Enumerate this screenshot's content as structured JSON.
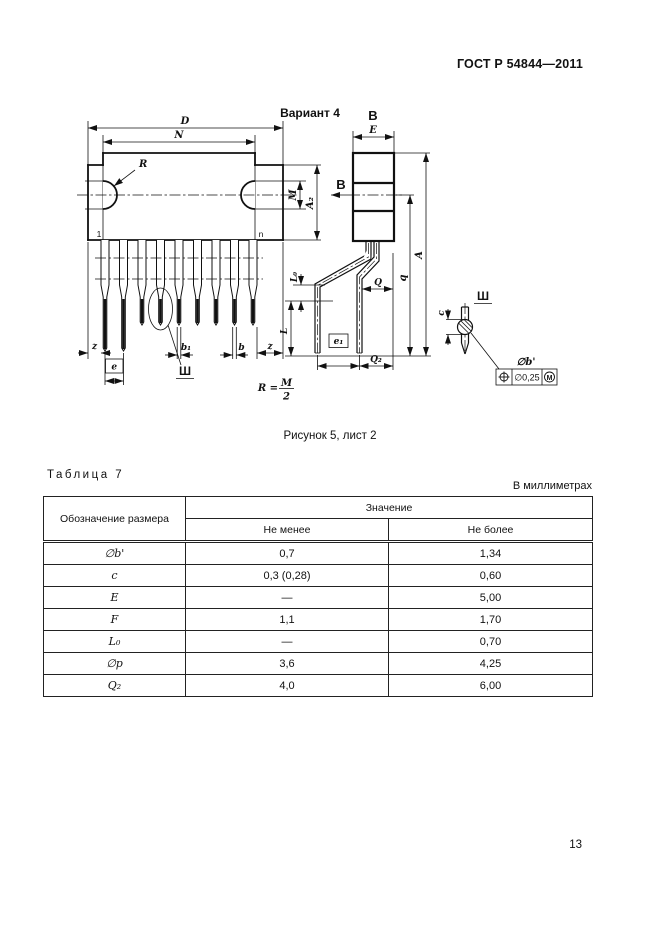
{
  "page": {
    "standard": "ГОСТ Р 54844—2011",
    "number": "13"
  },
  "figure": {
    "variant": "Вариант 4",
    "caption": "Рисунок 5, лист 2",
    "view_letter": "В",
    "detail_letter": "Ш",
    "formula_lhs": "R =",
    "formula_num": "M",
    "formula_den": "2",
    "dims": {
      "D": "D",
      "N": "N",
      "R": "R",
      "M": "M",
      "A2": "A₂",
      "pin_first": "1",
      "pin_last": "n",
      "z_left": "z",
      "z_right": "z",
      "e": "e",
      "b1": "b₁",
      "b": "b",
      "E": "E",
      "A": "A",
      "q": "q",
      "Q": "Q",
      "L0": "L₀",
      "L": "L",
      "e1": "e₁",
      "Q2": "Q₂",
      "c": "c",
      "db": "∅b'",
      "tol_value": "∅0,25",
      "tol_modifier": "M"
    }
  },
  "table": {
    "title": "Таблица 7",
    "units_note": "В миллиметрах",
    "col_symbol": "Обозначение размера",
    "col_value": "Значение",
    "col_min": "Не менее",
    "col_max": "Не более",
    "rows": [
      {
        "symbol": "∅b'",
        "min": "0,7",
        "max": "1,34"
      },
      {
        "symbol": "c",
        "min": "0,3 (0,28)",
        "max": "0,60"
      },
      {
        "symbol": "E",
        "min": "—",
        "max": "5,00"
      },
      {
        "symbol": "F",
        "min": "1,1",
        "max": "1,70"
      },
      {
        "symbol": "L₀",
        "min": "—",
        "max": "0,70"
      },
      {
        "symbol": "∅p",
        "min": "3,6",
        "max": "4,25"
      },
      {
        "symbol": "Q₂",
        "min": "4,0",
        "max": "6,00"
      }
    ]
  }
}
